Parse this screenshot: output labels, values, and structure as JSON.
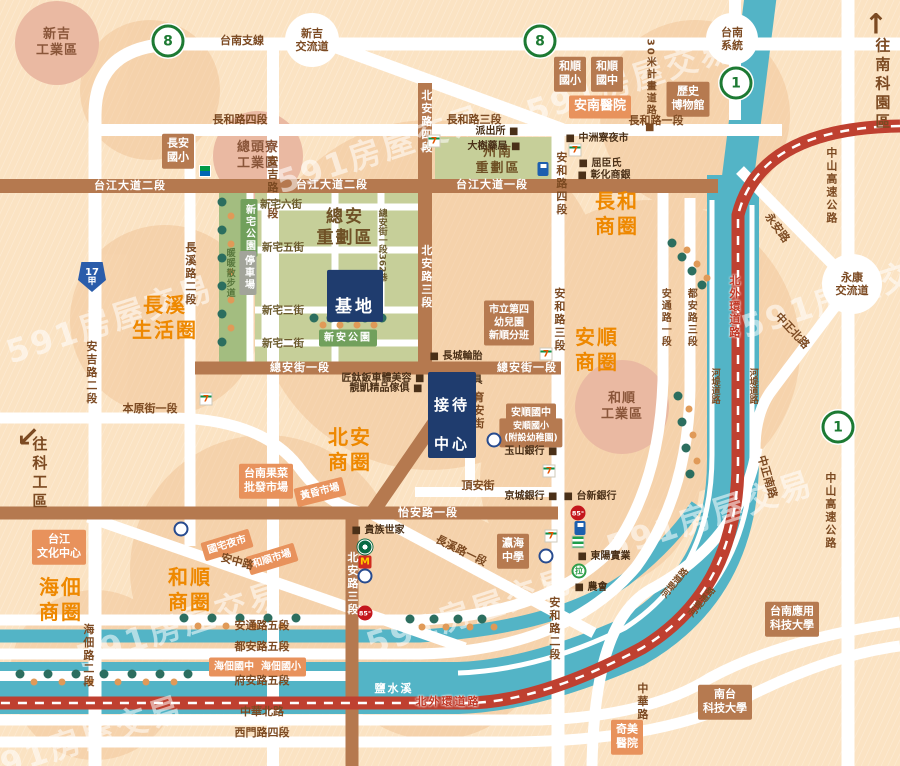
{
  "watermark": {
    "text": "591房屋交易"
  },
  "palette": {
    "background": "#fbe3c3",
    "road_white": "#ffffff",
    "road_brown": "#b5794f",
    "water_teal": "#53b4c6",
    "ring_road_red": "#bf4030",
    "zone_green": "#c6cf99",
    "park_green": "#a3bd80",
    "box_brown": "#b67a50",
    "box_orange": "#e8925c",
    "box_navy": "#1f3c6e",
    "district_orange": "#ee8800",
    "label_brown": "#7c4a22"
  },
  "site": {
    "label": "基地"
  },
  "reception": {
    "line1": "接待",
    "line2": "中心"
  },
  "districts": [
    {
      "text": "長溪\n生活圈",
      "x": 165,
      "y": 318
    },
    {
      "text": "北安\n商圈",
      "x": 350,
      "y": 450
    },
    {
      "text": "長和\n商圈",
      "x": 617,
      "y": 214
    },
    {
      "text": "安順\n商圈",
      "x": 597,
      "y": 350
    },
    {
      "text": "和順\n商圈",
      "x": 190,
      "y": 590
    },
    {
      "text": "海佃\n商圈",
      "x": 61,
      "y": 600
    }
  ],
  "industrial_areas": [
    {
      "text": "新吉\n工業區",
      "x": 57,
      "y": 43
    },
    {
      "text": "總頭寮\n工業區",
      "x": 258,
      "y": 156
    },
    {
      "text": "和順\n工業區",
      "x": 622,
      "y": 407
    }
  ],
  "interchanges": [
    {
      "text": "新吉\n交流道",
      "x": 312,
      "y": 40,
      "r": 27
    },
    {
      "text": "台南\n系統",
      "x": 732,
      "y": 39,
      "r": 26
    },
    {
      "text": "永康\n交流道",
      "x": 852,
      "y": 284,
      "r": 30
    }
  ],
  "zone_titles": [
    {
      "text": "總安\n重劃區",
      "x": 345,
      "y": 228,
      "size": 17
    },
    {
      "text": "州南\n重劃區",
      "x": 498,
      "y": 161,
      "size": 13
    }
  ],
  "park_labels": [
    {
      "text": "新宅公園",
      "x": 249,
      "y": 228,
      "cls": "greenv"
    },
    {
      "text": "新安公園",
      "x": 348,
      "y": 338,
      "cls": "greenh"
    },
    {
      "text": "停車場",
      "x": 248,
      "y": 273,
      "cls": "grayv"
    }
  ],
  "walkway_label": {
    "text": "暖暖散步道",
    "x": 229,
    "y": 273
  },
  "buildings": [
    {
      "text": "長安\n國小",
      "cls": "brown",
      "x": 178,
      "y": 151
    },
    {
      "text": "和順\n國小",
      "cls": "brown",
      "x": 570,
      "y": 74
    },
    {
      "text": "和順\n國中",
      "cls": "brown",
      "x": 607,
      "y": 74
    },
    {
      "text": "歷史\n博物館",
      "cls": "brown",
      "x": 688,
      "y": 99
    },
    {
      "text": "市立第四\n幼兒園\n新順分班",
      "cls": "brown",
      "x": 509,
      "y": 323,
      "size": 10
    },
    {
      "text": "安順國中",
      "cls": "brown",
      "x": 531,
      "y": 413,
      "size": 10
    },
    {
      "text": "安順國小\n(附設幼稚園)",
      "cls": "brown",
      "x": 531,
      "y": 433,
      "size": 9
    },
    {
      "text": "瀛海\n中學",
      "cls": "brown",
      "x": 513,
      "y": 551
    },
    {
      "text": "台南應用\n科技大學",
      "cls": "brown",
      "x": 792,
      "y": 619
    },
    {
      "text": "南台\n科技大學",
      "cls": "brown",
      "x": 725,
      "y": 702
    },
    {
      "text": "安南醫院",
      "cls": "orange",
      "x": 600,
      "y": 107,
      "size": 13
    },
    {
      "text": "台江\n文化中心",
      "cls": "orange",
      "x": 59,
      "y": 547
    },
    {
      "text": "台南果菜\n批發市場",
      "cls": "orange",
      "x": 266,
      "y": 481
    },
    {
      "text": "奇美\n醫院",
      "cls": "orange",
      "x": 627,
      "y": 737
    },
    {
      "text": "海佃國中",
      "cls": "orange",
      "x": 234,
      "y": 667,
      "size": 10
    },
    {
      "text": "海佃國小",
      "cls": "orange",
      "x": 281,
      "y": 667,
      "size": 10
    }
  ],
  "market_labels": [
    {
      "text": "黃昏市場",
      "x": 320,
      "y": 492,
      "rot": -14
    },
    {
      "text": "國宅夜市",
      "x": 227,
      "y": 545,
      "rot": -17
    },
    {
      "text": "和順市場",
      "x": 272,
      "y": 559,
      "rot": -17
    }
  ],
  "road_labels": [
    {
      "t": "台南支線",
      "x": 242,
      "y": 41,
      "c": "b"
    },
    {
      "t": "長和路四段",
      "x": 240,
      "y": 120,
      "c": "b"
    },
    {
      "t": "長和路三段",
      "x": 474,
      "y": 120,
      "c": "b"
    },
    {
      "t": "長和路一段",
      "x": 656,
      "y": 121,
      "c": "b"
    },
    {
      "t": "本原街一段",
      "x": 150,
      "y": 409,
      "c": "b"
    },
    {
      "t": "頂安街",
      "x": 478,
      "y": 486,
      "c": "b"
    },
    {
      "t": "安通路五段",
      "x": 262,
      "y": 626,
      "c": "b"
    },
    {
      "t": "都安路五段",
      "x": 262,
      "y": 647,
      "c": "b"
    },
    {
      "t": "府安路五段",
      "x": 262,
      "y": 681,
      "c": "b"
    },
    {
      "t": "中華北路",
      "x": 262,
      "y": 712,
      "c": "b"
    },
    {
      "t": "西門路四段",
      "x": 262,
      "y": 733,
      "c": "b"
    },
    {
      "t": "安中路",
      "x": 237,
      "y": 562,
      "c": "b",
      "r": 15
    },
    {
      "t": "長溪路一段",
      "x": 461,
      "y": 551,
      "c": "b",
      "r": 26
    },
    {
      "t": "永安路",
      "x": 777,
      "y": 228,
      "c": "b",
      "r": 54
    },
    {
      "t": "中正北路",
      "x": 792,
      "y": 331,
      "c": "b",
      "r": 47
    },
    {
      "t": "中正南路",
      "x": 767,
      "y": 477,
      "c": "b",
      "r": 74
    },
    {
      "t": "安吉路一段",
      "x": 272,
      "y": 188,
      "c": "b v"
    },
    {
      "t": "安吉路二段",
      "x": 91,
      "y": 373,
      "c": "b v"
    },
    {
      "t": "長溪路二段",
      "x": 190,
      "y": 274,
      "c": "b v"
    },
    {
      "t": "海佃路二段",
      "x": 88,
      "y": 656,
      "c": "b v"
    },
    {
      "t": "安和路四段",
      "x": 561,
      "y": 184,
      "c": "b v"
    },
    {
      "t": "安和路三段",
      "x": 559,
      "y": 320,
      "c": "b v"
    },
    {
      "t": "安和路二段",
      "x": 554,
      "y": 629,
      "c": "b v"
    },
    {
      "t": "育安街",
      "x": 478,
      "y": 411,
      "c": "b v"
    },
    {
      "t": "中華路",
      "x": 642,
      "y": 702,
      "c": "b v"
    },
    {
      "t": "中山高速公路",
      "x": 831,
      "y": 186,
      "c": "b v"
    },
    {
      "t": "中山高速公路",
      "x": 830,
      "y": 511,
      "c": "b v"
    },
    {
      "t": "安通路一段",
      "x": 664,
      "y": 318,
      "c": "b v s10"
    },
    {
      "t": "都安路三段",
      "x": 690,
      "y": 318,
      "c": "b v s10"
    },
    {
      "t": "河堤道路",
      "x": 714,
      "y": 386,
      "c": "b v s9"
    },
    {
      "t": "河堤道路",
      "x": 752,
      "y": 386,
      "c": "b v s9"
    },
    {
      "t": "河堤道路",
      "x": 676,
      "y": 584,
      "c": "b s9",
      "r": -50
    },
    {
      "t": "河堤道路",
      "x": 703,
      "y": 603,
      "c": "b s9",
      "r": -50
    },
    {
      "t": "30米計畫道路 ■",
      "x": 649,
      "y": 87,
      "c": "b v s10"
    },
    {
      "t": "總安街一段362巷",
      "x": 381,
      "y": 245,
      "c": "st v s9"
    },
    {
      "t": "新宅六街",
      "x": 281,
      "y": 205,
      "c": "st"
    },
    {
      "t": "新宅五街",
      "x": 283,
      "y": 248,
      "c": "st"
    },
    {
      "t": "新宅三街",
      "x": 283,
      "y": 311,
      "c": "st"
    },
    {
      "t": "新宅二街",
      "x": 283,
      "y": 344,
      "c": "st"
    },
    {
      "t": "台江大道二段",
      "x": 130,
      "y": 186,
      "c": "w"
    },
    {
      "t": "台江大道二段",
      "x": 332,
      "y": 185,
      "c": "w"
    },
    {
      "t": "台江大道一段",
      "x": 492,
      "y": 185,
      "c": "w"
    },
    {
      "t": "總安街一段",
      "x": 300,
      "y": 368,
      "c": "w"
    },
    {
      "t": "總安街一段",
      "x": 527,
      "y": 368,
      "c": "w"
    },
    {
      "t": "怡安路一段",
      "x": 428,
      "y": 513,
      "c": "w"
    },
    {
      "t": "北安路四段",
      "x": 426,
      "y": 122,
      "c": "w v"
    },
    {
      "t": "北安路三段",
      "x": 426,
      "y": 277,
      "c": "w v"
    },
    {
      "t": "北安路三段",
      "x": 352,
      "y": 584,
      "c": "w v"
    },
    {
      "t": "北外環道路",
      "x": 448,
      "y": 702,
      "c": "rd"
    },
    {
      "t": "北外環道路",
      "x": 734,
      "y": 307,
      "c": "rd v"
    },
    {
      "t": "鹽水溪",
      "x": 394,
      "y": 689,
      "c": "tl"
    }
  ],
  "poi_texts": [
    {
      "t": "派出所 ■",
      "x": 497,
      "y": 132
    },
    {
      "t": "大樹藥局 ■",
      "x": 494,
      "y": 147
    },
    {
      "t": "■ 中洲寮夜市",
      "x": 597,
      "y": 139
    },
    {
      "t": "■ 屈臣氏",
      "x": 600,
      "y": 164
    },
    {
      "t": "■ 彰化商銀",
      "x": 604,
      "y": 176
    },
    {
      "t": "■ 長城輪胎",
      "x": 456,
      "y": 357
    },
    {
      "t": "■ 圓明佛具",
      "x": 456,
      "y": 381
    },
    {
      "t": "匠鈦鈑車體美容 ■",
      "x": 383,
      "y": 379
    },
    {
      "t": "靚凱精品傢俱 ■",
      "x": 386,
      "y": 389
    },
    {
      "t": "■ 貴族世家",
      "x": 378,
      "y": 531
    },
    {
      "t": "玉山銀行 ■",
      "x": 531,
      "y": 452
    },
    {
      "t": "京城銀行 ■",
      "x": 531,
      "y": 497
    },
    {
      "t": "■ 台新銀行",
      "x": 590,
      "y": 497
    },
    {
      "t": "■ 東陽實業",
      "x": 604,
      "y": 557
    },
    {
      "t": "■ 農會",
      "x": 591,
      "y": 588
    }
  ],
  "shields": [
    {
      "type": "freeway",
      "num": "8",
      "x": 168,
      "y": 41
    },
    {
      "type": "freeway",
      "num": "8",
      "x": 540,
      "y": 41
    },
    {
      "type": "freeway",
      "num": "1",
      "x": 736,
      "y": 83
    },
    {
      "type": "freeway",
      "num": "1",
      "x": 838,
      "y": 427
    },
    {
      "type": "provincial",
      "line1": "17",
      "line2": "甲",
      "x": 92,
      "y": 277
    }
  ],
  "directions": [
    {
      "text": "往南科園區",
      "arrow": "↑",
      "x": 882,
      "y": 85,
      "ax": 876,
      "ay": 24
    },
    {
      "text": "往科工區",
      "arrow": "↙",
      "x": 39,
      "y": 474,
      "ax": 28,
      "ay": 437
    }
  ],
  "pois": [
    {
      "type": "seven",
      "label": "7-eleven",
      "x": 434,
      "y": 141
    },
    {
      "type": "seven",
      "label": "7-eleven",
      "x": 575,
      "y": 150
    },
    {
      "type": "seven",
      "label": "7-eleven",
      "x": 206,
      "y": 399
    },
    {
      "type": "seven",
      "label": "7-eleven",
      "x": 546,
      "y": 354
    },
    {
      "type": "seven",
      "label": "7-eleven",
      "x": 549,
      "y": 471
    },
    {
      "type": "seven",
      "label": "7-eleven",
      "x": 551,
      "y": 536
    },
    {
      "type": "family",
      "label": "familymart",
      "x": 205,
      "y": 171
    },
    {
      "type": "gas",
      "label": "gas-station",
      "x": 543,
      "y": 169
    },
    {
      "type": "gas",
      "label": "gas-station",
      "x": 580,
      "y": 528
    },
    {
      "type": "bank",
      "label": "bank",
      "x": 494,
      "y": 440
    },
    {
      "type": "bank",
      "label": "bank",
      "x": 546,
      "y": 556
    },
    {
      "type": "bank",
      "label": "bank",
      "x": 365,
      "y": 576
    },
    {
      "type": "bank",
      "label": "bank",
      "x": 181,
      "y": 529
    },
    {
      "type": "c85",
      "label": "85cafe",
      "x": 578,
      "y": 513
    },
    {
      "type": "c85",
      "label": "85cafe",
      "x": 365,
      "y": 613
    },
    {
      "type": "sb",
      "label": "starbucks",
      "x": 365,
      "y": 547
    },
    {
      "type": "mcd",
      "label": "mcdonalds",
      "x": 365,
      "y": 562
    },
    {
      "type": "px",
      "label": "pxmart",
      "x": 578,
      "y": 542
    },
    {
      "type": "laya",
      "label": "laya-burger",
      "x": 579,
      "y": 571
    }
  ],
  "poi_glyphs": {
    "seven": "7",
    "mcd": "M",
    "c85": "85°",
    "laya": "拉"
  }
}
